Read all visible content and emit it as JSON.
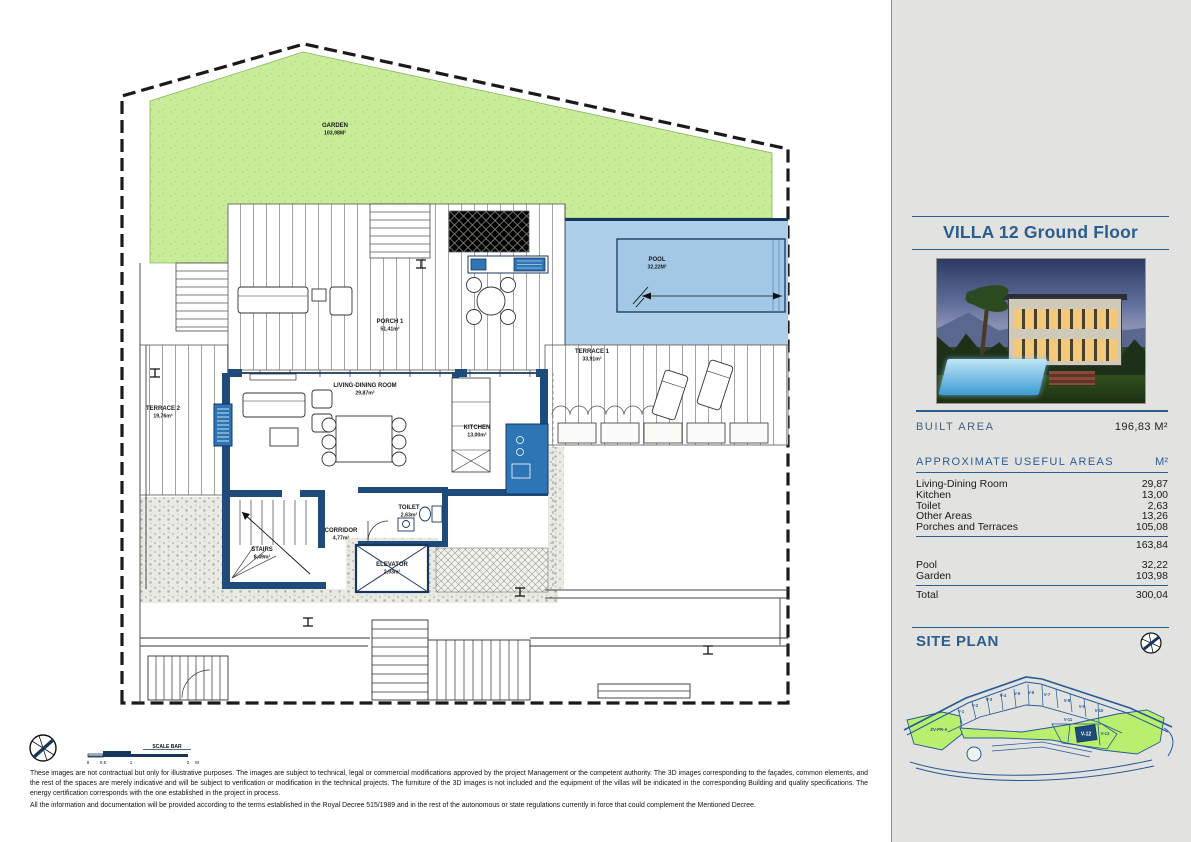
{
  "panel": {
    "title": "VILLA 12 Ground Floor",
    "built_area_label": "BUILT AREA",
    "built_area_value": "196,83 M²",
    "useful_areas": {
      "heading": "APPROXIMATE USEFUL AREAS",
      "unit": "M²",
      "rows": [
        {
          "label": "Living-Dining Room",
          "value": "29,87"
        },
        {
          "label": "Kitchen",
          "value": "13,00"
        },
        {
          "label": "Toilet",
          "value": "2,63"
        },
        {
          "label": "Other Areas",
          "value": "13,26"
        },
        {
          "label": "Porches and Terraces",
          "value": "105,08"
        }
      ],
      "subtotal": "163,84",
      "outdoor_rows": [
        {
          "label": "Pool",
          "value": "32,22"
        },
        {
          "label": "Garden",
          "value": "103,98"
        }
      ],
      "total_label": "Total",
      "total_value": "300,04"
    },
    "site_plan": {
      "heading": "SITE PLAN",
      "zone_label": "ZV-PR-A",
      "lots": [
        "V-1",
        "V-2",
        "V-3",
        "V-4",
        "V-5",
        "V-6",
        "V-7",
        "V-8",
        "V-9",
        "V-10",
        "V-11",
        "V-13"
      ],
      "highlighted_lot": "V-12"
    }
  },
  "plan": {
    "garden_name": "GARDEN",
    "garden_area": "103,98M²",
    "pool_name": "POOL",
    "pool_area": "32,22M²",
    "porch_name": "PORCH 1",
    "porch_area": "51,41m²",
    "terrace1_name": "TERRACE 1",
    "terrace1_area": "33,91m²",
    "terrace2_name": "TERRACE 2",
    "terrace2_area": "19,76m²",
    "living_name": "LIVING-DINING ROOM",
    "living_area": "29,87m²",
    "kitchen_name": "KITCHEN",
    "kitchen_area": "13,00m²",
    "toilet_name": "TOILET",
    "toilet_area": "2,63m²",
    "corridor_name": "CORRIDOR",
    "corridor_area": "4,77m²",
    "elevator_name": "ELEVATOR",
    "elevator_area": "2,93m²",
    "stairs_name": "STAIRS",
    "stairs_area": "8,49m²",
    "scale_bar_label": "SCALE BAR",
    "scale_ticks": [
      "0",
      "0.5",
      "1",
      "2"
    ],
    "scale_unit": "M"
  },
  "colors": {
    "accent_blue": "#2b5d8e",
    "wall_navy": "#1e4b7a",
    "fixture_blue": "#2e75b6",
    "pool_blue": "#aecfe9",
    "grass_green": "#c9ec9b",
    "site_green": "#b9ee6e",
    "panel_bg": "#e2e2e0"
  },
  "disclaimer": {
    "p1": "These images are not contractual but only for illustrative purposes. The images are subject to technical, legal or commercial modifications approved by the project Management or the competent authority. The 3D images corresponding to the façades, common elements, and the rest of the spaces are merely indicative and will be subject to verification or modification in the technical projects. The furniture of the 3D images is not included and the equipment of the villas will be indicated in the corresponding Building and quality specifications. The energy certification corresponds with the one established in the project in process.",
    "p2": "All the information and documentation will be provided according to the terms established in the Royal Decree 515/1989 and in the rest of the autonomous or state regulations currently in force that could complement the Mentioned Decree."
  }
}
